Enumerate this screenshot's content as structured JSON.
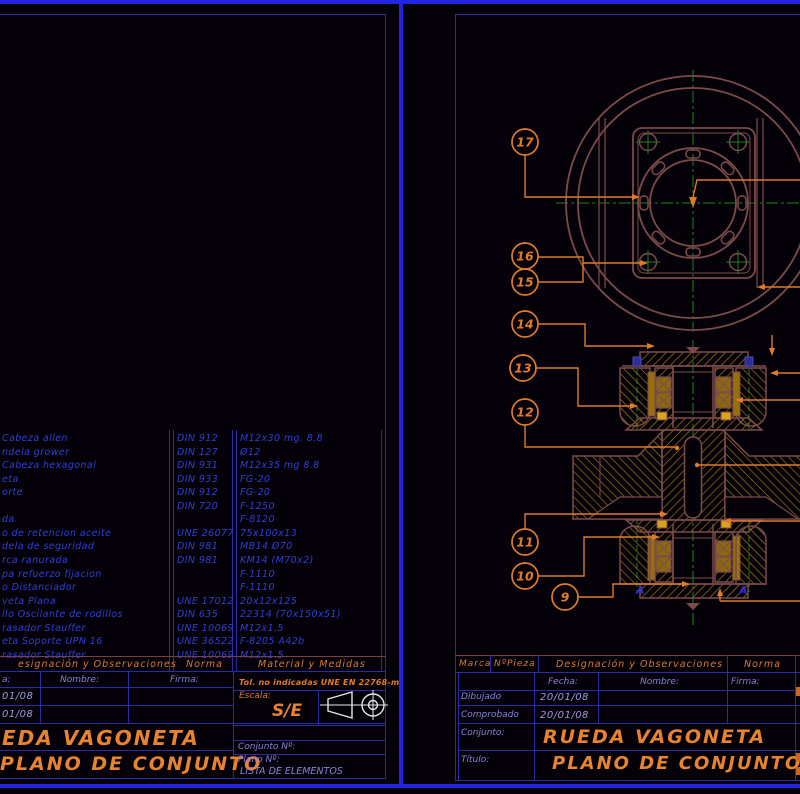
{
  "colors": {
    "border_blue": "#2424E0",
    "frame_blue": "#2B2BA6",
    "list_text_blue": "#2F3FD8",
    "label_blue": "#8484DA",
    "orange": "#D97B30",
    "title_orange": "#E8832F",
    "drawing_maroon": "#7D4A4A",
    "hatch_gold": "#A87E12",
    "bright_gold": "#D8A41C",
    "centerline_green": "#1E821E",
    "marker_blue": "#2C2CC8",
    "symbol_white": "#E6E6E6"
  },
  "left_sheet": {
    "list_headers": {
      "designacion": "esignación y Observaciones",
      "norma": "Norma",
      "material": "Material y Medidas"
    },
    "list_rows": [
      {
        "designacion": "Cabeza allen",
        "norma": "DIN 912",
        "material": "M12x30 mg. 8.8"
      },
      {
        "designacion": "ndela grower",
        "norma": "DIN 127",
        "material": "Ø12"
      },
      {
        "designacion": "Cabeza hexagonal",
        "norma": "DIN 931",
        "material": "M12x35 mg 8.8"
      },
      {
        "designacion": "eta",
        "norma": "DIN 933",
        "material": "FG-20"
      },
      {
        "designacion": "orte",
        "norma": "DIN 912",
        "material": "FG-20"
      },
      {
        "designacion": "",
        "norma": "DIN 720",
        "material": "F-1250"
      },
      {
        "designacion": "da",
        "norma": "",
        "material": "F-8120"
      },
      {
        "designacion": "o de retencion aceite",
        "norma": "UNE 26077",
        "material": "75x100x13"
      },
      {
        "designacion": "dela de seguridad",
        "norma": "DIN 981",
        "material": "MB14 Ø70"
      },
      {
        "designacion": "rca ranurada",
        "norma": "DIN 981",
        "material": "KM14 (M70x2)"
      },
      {
        "designacion": "pa refuerzo fijacion",
        "norma": "",
        "material": "F-1110"
      },
      {
        "designacion": "o Distanciador",
        "norma": "",
        "material": "F-1110"
      },
      {
        "designacion": "veta Plana",
        "norma": "UNE 17012",
        "material": "20x12x125"
      },
      {
        "designacion": "llo Oscilante de rodillos",
        "norma": "DIN 635",
        "material": "22314 (70x150x51)"
      },
      {
        "designacion": "rasador Stauffer",
        "norma": "UNE 10069",
        "material": "M12x1.5"
      },
      {
        "designacion": "eta Soporte UPN 16",
        "norma": "UNE 36522",
        "material": "F-8205 A42b"
      },
      {
        "designacion": "rasador Stauffer",
        "norma": "UNE 10069",
        "material": "M12x1.5"
      }
    ],
    "title_block": {
      "fecha_fragment": "a:",
      "nombre_label": "Nombre:",
      "firma_label": "Firma:",
      "tol_note": "Tol. no indicadas UNE EN 22768-m",
      "date_dibujado": "01/08",
      "date_comprobado": "01/08",
      "escala_label": "Escala:",
      "escala_value": "S/E",
      "conjunto_title": "EDA VAGONETA",
      "plano_title": "PLANO DE CONJUNTO",
      "conjunto_n_label": "Conjunto Nº:",
      "plano_n_label": "Plano Nº:",
      "plano_n_value": "LISTA DE ELEMENTOS"
    }
  },
  "right_sheet": {
    "list_headers": {
      "marca": "Marca",
      "npieza": "NºPieza",
      "designacion": "Designación y Observaciones",
      "norma": "Norma"
    },
    "title_block": {
      "fecha_label": "Fecha:",
      "nombre_label": "Nombre:",
      "firma_label": "Firma:",
      "dibujado_label": "Dibujado",
      "comprobado_label": "Comprobado",
      "date_dibujado": "20/01/08",
      "date_comprobado": "20/01/08",
      "conjunto_label": "Conjunto:",
      "conjunto_value": "RUEDA VAGONETA",
      "titulo_label": "Título:",
      "titulo_value": "PLANO DE CONJUNTO"
    },
    "drawing": {
      "section_marker": "A",
      "balloons": [
        {
          "label": "17",
          "x": 525,
          "y": 142
        },
        {
          "label": "16",
          "x": 525,
          "y": 256
        },
        {
          "label": "15",
          "x": 525,
          "y": 282
        },
        {
          "label": "14",
          "x": 525,
          "y": 324
        },
        {
          "label": "13",
          "x": 523,
          "y": 368
        },
        {
          "label": "12",
          "x": 525,
          "y": 412
        },
        {
          "label": "11",
          "x": 525,
          "y": 542
        },
        {
          "label": "10",
          "x": 525,
          "y": 576
        },
        {
          "label": "9",
          "x": 565,
          "y": 597
        }
      ]
    }
  }
}
